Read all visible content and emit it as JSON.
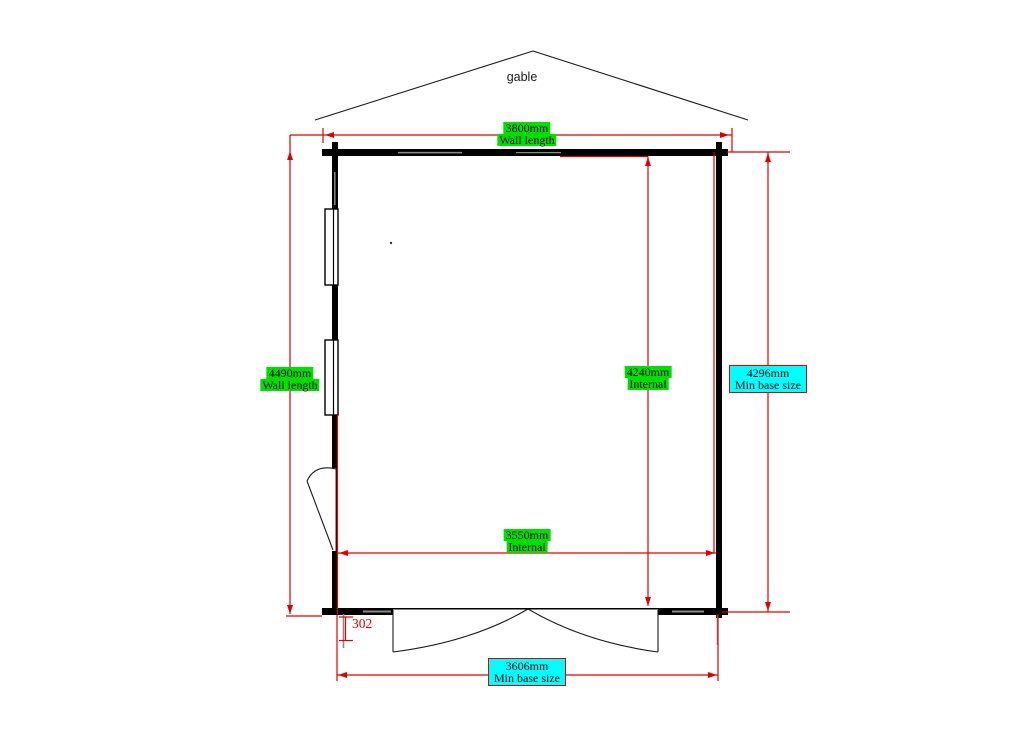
{
  "labels": {
    "gable": "gable",
    "wall_length_top": {
      "value": "3800mm",
      "caption": "Wall length"
    },
    "wall_length_left": {
      "value": "4490mm",
      "caption": "Wall length"
    },
    "internal_height": {
      "value": "4240mm",
      "caption": "Internal"
    },
    "min_base_right": {
      "value": "4296mm",
      "caption": "Min base size"
    },
    "internal_width": {
      "value": "3550mm",
      "caption": "Internal"
    },
    "min_base_bottom": {
      "value": "3606mm",
      "caption": "Min base size"
    },
    "door_offset": {
      "value": "302"
    }
  },
  "colors": {
    "dimension_red": "#e00000",
    "highlight_green": "#00e000",
    "highlight_cyan": "#00ffff",
    "wall_black": "#000000",
    "mark_gray": "#8a8a8a"
  }
}
